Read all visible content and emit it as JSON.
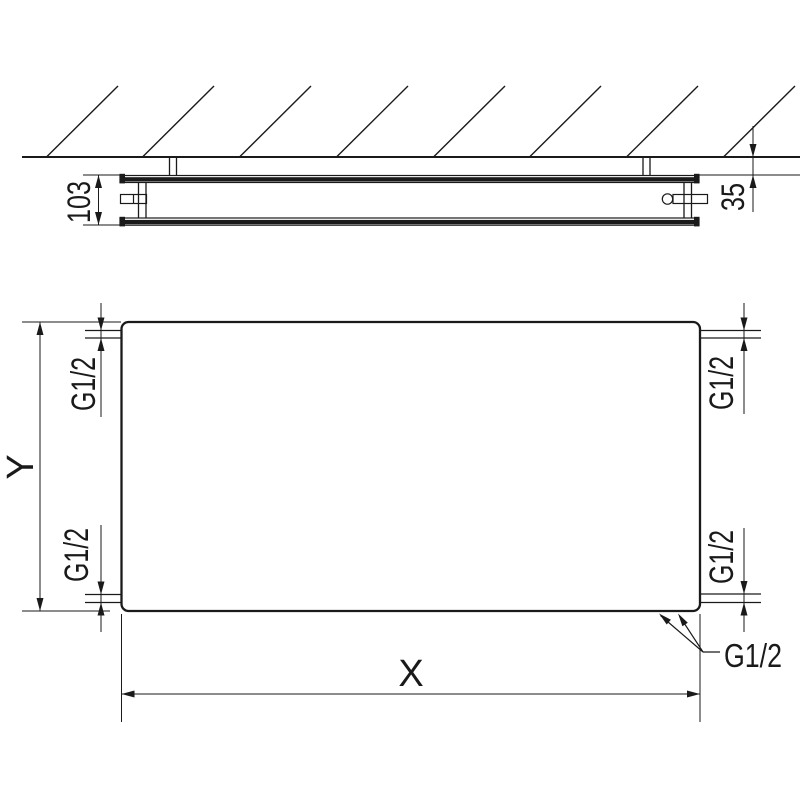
{
  "drawing": {
    "kind": "panel-radiator technical drawing, wall section above and front elevation below"
  },
  "labels": {
    "depth": "103",
    "wall_distance": "35",
    "width": "X",
    "height": "Y",
    "thread_top_left": "G1/2",
    "thread_top_right": "G1/2",
    "thread_bottom_left": "G1/2",
    "thread_bottom_right": "G1/2",
    "thread_bottom_center": "G1/2"
  },
  "colors": {
    "line": "#1a1a1a",
    "background": "#ffffff"
  }
}
